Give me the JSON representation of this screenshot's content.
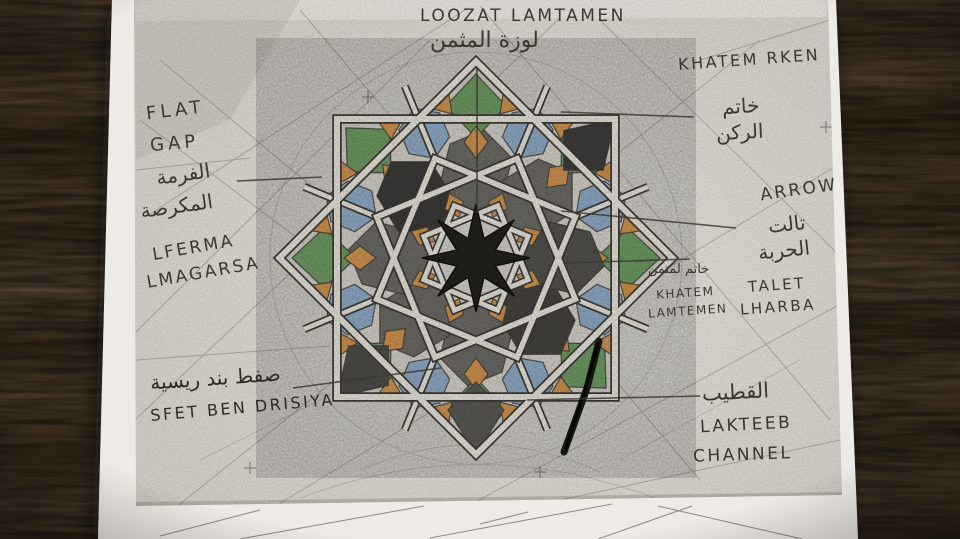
{
  "labels": {
    "loozat": {
      "en": "LOOZAT LAMTAMEN",
      "ar": "لوزة المثمن"
    },
    "khatem_rken": {
      "en": "KHATEM RKEN",
      "ar1": "خاتم",
      "ar2": "الركن"
    },
    "flat_gap": {
      "en1": "FLAT",
      "en2": "GAP",
      "ar1": "الفرمة",
      "ar2": "المكرصة"
    },
    "lferma": {
      "en1": "LFERMA",
      "en2": "LMAGARSA"
    },
    "arrow": {
      "en": "ARROW",
      "ar1": "تالت",
      "ar2": "الحربة"
    },
    "talet": {
      "en1": "TALET",
      "en2": "LHARBA"
    },
    "khatem_lamtemen": {
      "ar": "خاتم لمتمن",
      "en1": "KHATEM",
      "en2": "LAMTEMEN"
    },
    "sfet": {
      "ar": "صفط بند ريسية",
      "en": "SFET BEN DRISIYA"
    },
    "lakteeb": {
      "ar": "القطيب",
      "en1": "LAKTEEB",
      "en2": "CHANNEL"
    }
  },
  "palette": {
    "wood": "#4a3b2c",
    "wood_dark": "#352a1f",
    "paper": "#ece9e3",
    "tracing": "#d9d6cf",
    "pencil_ink": "#3a3631",
    "tile_green": "#6f9d63",
    "tile_blue": "#90adc9",
    "tile_orange": "#d29550",
    "tile_gray": "#6e6c67",
    "tile_black": "#23221e",
    "strap_ivory": "#eae7de",
    "marker_black": "#161613"
  }
}
